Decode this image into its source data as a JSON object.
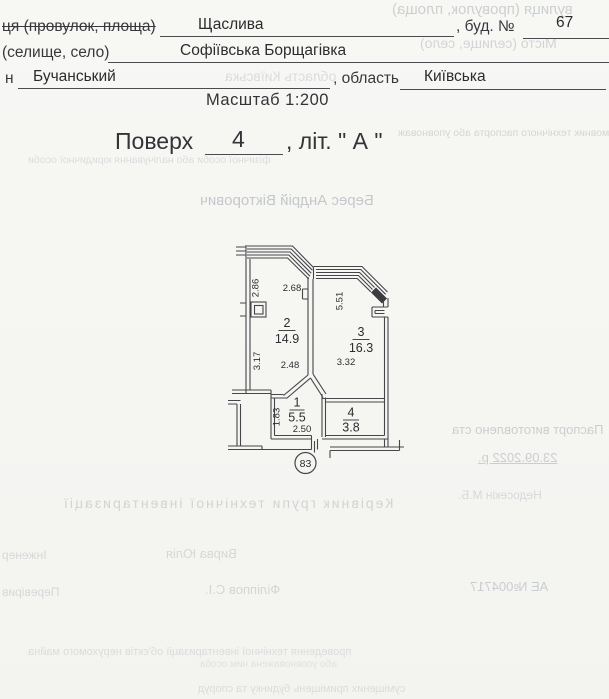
{
  "form": {
    "line1": {
      "label": "ця (провулок, площа)",
      "value": "Щаслива",
      "suffix": ", буд. №",
      "number": "67"
    },
    "line2": {
      "label": "(селище, село)",
      "value": "Софіївська Борщагівка"
    },
    "line3": {
      "prefix": "н",
      "value": "Бучанський",
      "suffix": ", область",
      "region": "Київська"
    },
    "scale": "Масштаб  1:200"
  },
  "title": {
    "word": "Поверх",
    "floor": "4",
    "tail": ", літ. \" А \""
  },
  "plan": {
    "rooms": [
      {
        "number": "2",
        "area": "14.9"
      },
      {
        "number": "3",
        "area": "16.3"
      },
      {
        "number": "1",
        "area": "5.5"
      },
      {
        "number": "4",
        "area": "3.8"
      }
    ],
    "dims": [
      "2.86",
      "2.68",
      "5.51",
      "3.17",
      "2.48",
      "3.32",
      "1.83",
      "2.50"
    ],
    "apartment": "83"
  },
  "bleed": {
    "items": [
      "вулиця (провулок, площа)",
      "Місто (селище, село)",
      "область Київська",
      "Замовник технічного паспорта або уповноваж",
      "фізичної особи або налічування юридичної особи",
      "Берес Андрій Вікторович",
      "Паспорт виготовлено ста",
      "23.09.2022 р.",
      "Керівник групи технічної інвентаризації",
      "Недосекін М.Б.",
      "Інженер",
      "Вирва Юлія",
      "Перевірив",
      "Філіппов С.І.",
      "АЕ №004717",
      "проведення технічної інвентаризації об'єктів нерухомого майна",
      "або уповноважена ним особа",
      "суміщених приміщень будинку та споруд"
    ]
  }
}
